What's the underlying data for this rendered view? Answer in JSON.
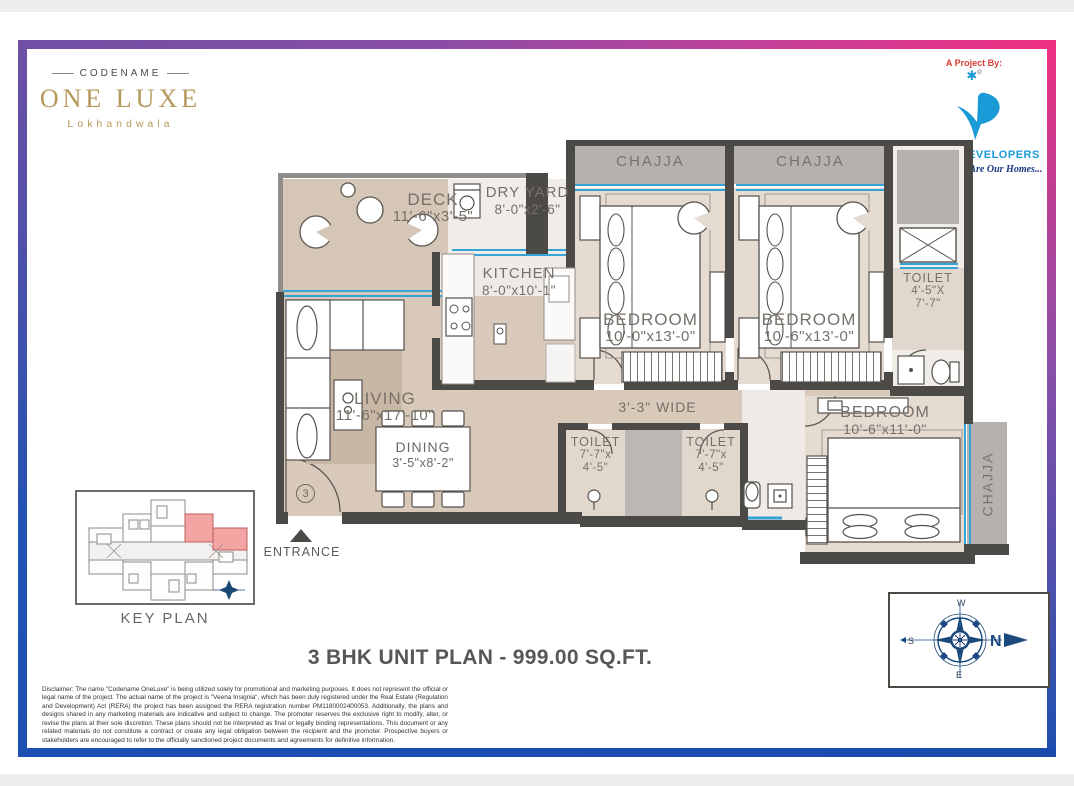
{
  "brand": {
    "codename": "CODENAME",
    "name": "ONE LUXE",
    "location": "Lokhandwala"
  },
  "developer": {
    "project_by": "A Project By:",
    "mark": "✱",
    "registered": "®",
    "name": "Veena Developers",
    "tagline": "Your Dreams... Are Our Homes..."
  },
  "rooms": {
    "deck": {
      "name": "DECK",
      "dim": "11'-6\"x3'-5\""
    },
    "dry_yard": {
      "name": "DRY YARD",
      "dim": "8'-0\"x2'-6\""
    },
    "kitchen": {
      "name": "KITCHEN",
      "dim": "8'-0\"x10'-1\""
    },
    "chajja_left": {
      "name": "CHAJJA"
    },
    "chajja_right": {
      "name": "CHAJJA"
    },
    "chajja_side": {
      "name": "CHAJJA"
    },
    "bedroom1": {
      "name": "BEDROOM",
      "dim": "10'-0\"x13'-0\""
    },
    "bedroom2": {
      "name": "BEDROOM",
      "dim": "10'-6\"x13'-0\""
    },
    "bedroom3": {
      "name": "BEDROOM",
      "dim": "10'-6\"x11'-0\""
    },
    "toilet_top": {
      "name": "TOILET",
      "dim1": "4'-5\"X",
      "dim2": "7'-7\""
    },
    "toilet_a": {
      "name": "TOILET",
      "dim1": "7'-7\"x",
      "dim2": "4'-5\""
    },
    "toilet_b": {
      "name": "TOILET",
      "dim1": "7'-7\"x",
      "dim2": "4'-5\""
    },
    "living": {
      "name": "LIVING",
      "dim": "11'-6\"x17'-10\""
    },
    "dining": {
      "name": "DINING",
      "dim": "3'-5\"x8'-2\""
    },
    "passage": {
      "label": "3'-3\" WIDE"
    }
  },
  "plan": {
    "entrance": "ENTRANCE",
    "unit_number": "3"
  },
  "key_plan": {
    "label": "KEY PLAN"
  },
  "title": "3 BHK UNIT PLAN - 999.00 SQ.FT.",
  "compass": {
    "n": "N",
    "s": "S",
    "e": "E",
    "w": "W"
  },
  "disclaimer": "Disclaimer:  The name \"Codename OneLuxe\" is being utilized solely for promotional and marketing purposes. It does not represent the official or legal name of the project. The actual name of the project is \"Veena Insignia\", which has been duly registered under the Real Estate (Regulation and Development) Act (RERA) the project has been assigned the RERA registration number PM1180002400053. Additionally, the plans and designs shared in any marketing materials are indicative and subject to change. The promoter reserves the exclusive right to modify, alter, or revise the plans at their sole discretion. These plans should not be interpreted as final or legally binding representations. This document or any related materials do not constitute a contract or create any legal obligation between the recipient and the promoter. Prospective buyers or stakeholders are encouraged to refer to the officially sanctioned project documents and agreements for definitive information.",
  "colors": {
    "brand_gold": "#b5995a",
    "developer_blue": "#1a9ad6",
    "tagline_navy": "#1b3a86",
    "wall": "#4c4a46",
    "floor_tan": "#d6c6b8",
    "chajja_gray": "#b5b2ae",
    "window_blue": "#35a3d8",
    "keyplan_highlight": "#f2a5a3",
    "compass_navy": "#1d4a7e",
    "frame_purple": "#6f4fa4",
    "frame_pink": "#ee2f80",
    "frame_blue": "#1d50b0"
  }
}
